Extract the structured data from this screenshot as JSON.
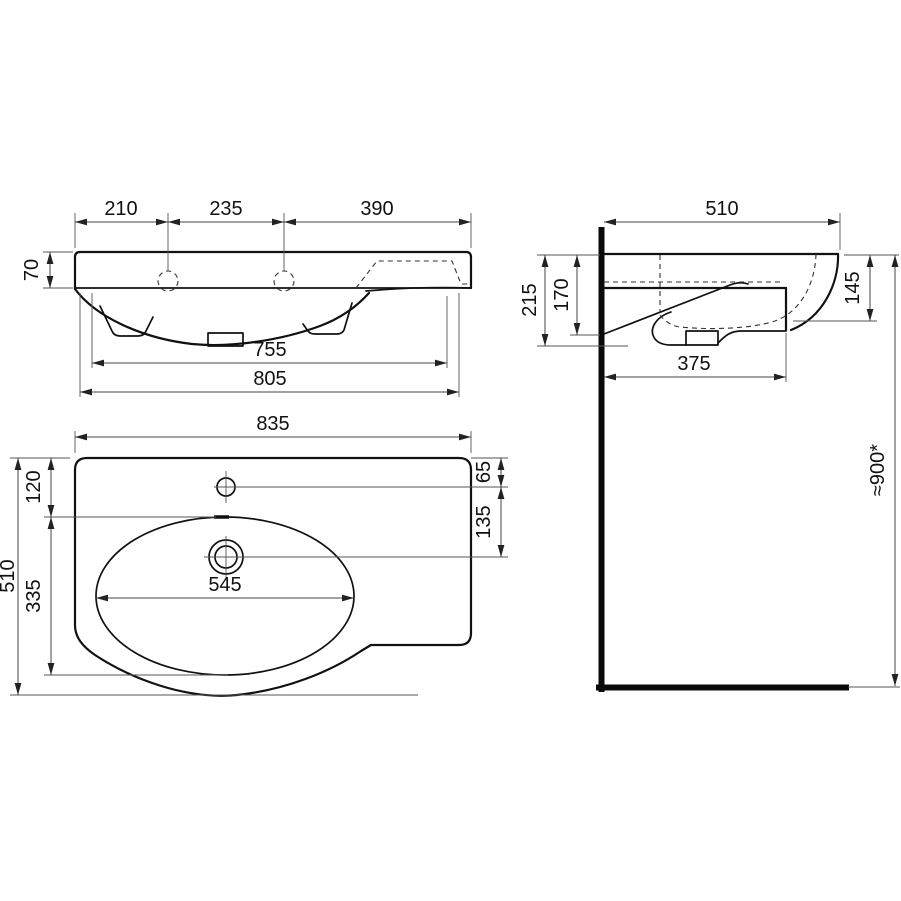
{
  "front_view": {
    "dim_210": "210",
    "dim_235": "235",
    "dim_390": "390",
    "dim_70": "70",
    "dim_755": "755",
    "dim_805": "805"
  },
  "side_view": {
    "dim_510": "510",
    "dim_215": "215",
    "dim_170": "170",
    "dim_145": "145",
    "dim_375": "375",
    "dim_height": "≈900*"
  },
  "plan_view": {
    "dim_835": "835",
    "dim_510": "510",
    "dim_120": "120",
    "dim_335": "335",
    "dim_545": "545",
    "dim_65": "65",
    "dim_135": "135"
  },
  "colors": {
    "object_line": "#111111",
    "dimension_line": "#444444",
    "background": "#ffffff"
  }
}
